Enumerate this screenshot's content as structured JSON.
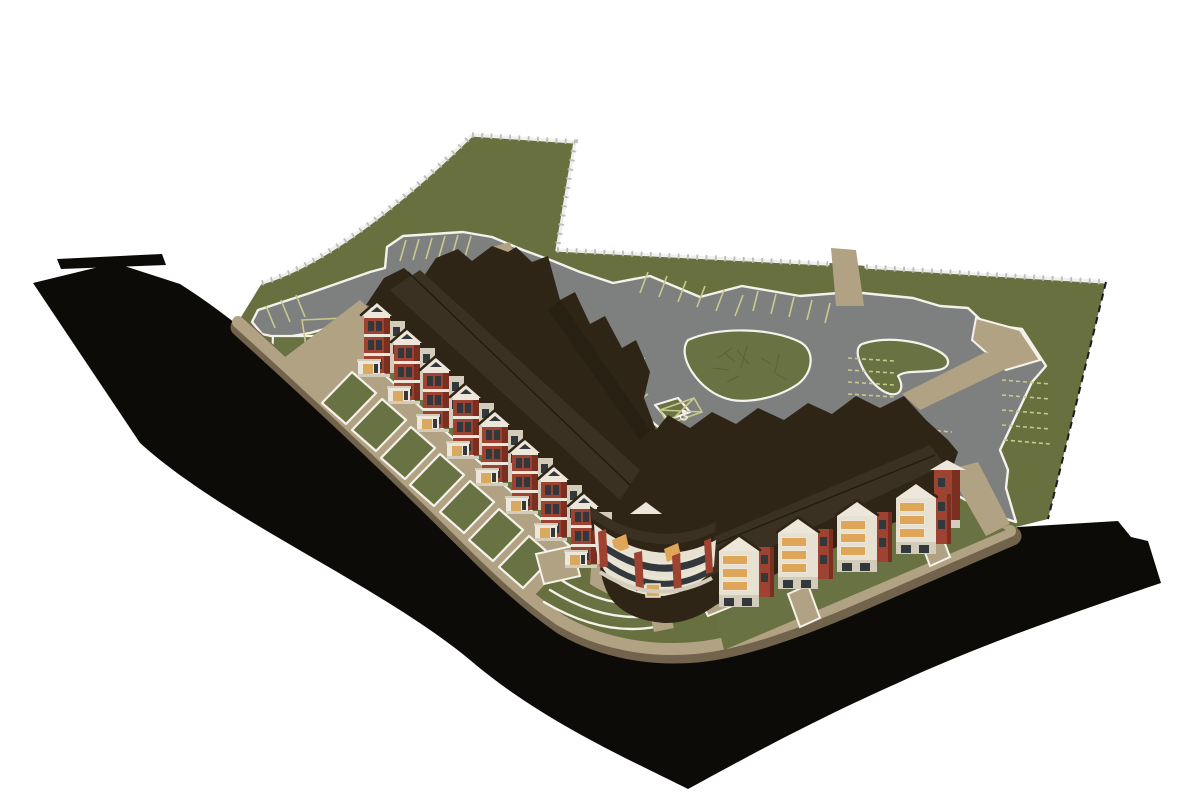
{
  "scene": {
    "background": "#ffffff"
  },
  "site": {
    "left_wing_unit_count": 8,
    "right_wing_module_count": 4,
    "accessible_stall_symbol_count": 3
  },
  "icons": {
    "accessible_parking_icon": "♿"
  },
  "colors": {
    "background": "#ffffff",
    "road": "#0d0b08",
    "lawn": "#68703f",
    "lawn_island": "#697243",
    "parking": "#7e807f",
    "walk": "#b2a284",
    "walk_dark": "#71634c",
    "curb": "#f4f2ea",
    "stripe": "#c9c98c",
    "roof": "#2e2517",
    "roof_light": "#3b3122",
    "roof_ridge": "#211b10",
    "brick": "#9e4231",
    "brick_dark": "#7b2f21",
    "trim": "#ece7da",
    "trim_shade": "#d3ccba",
    "cream": "#e6e1d0",
    "window": "#33383c",
    "amber": "#dfa558",
    "door": "#d8a95e",
    "fence": "#f0efeb",
    "fence_post": "#bdbdbd",
    "boundary": "#1c1c1c",
    "twig": "#59633b"
  }
}
